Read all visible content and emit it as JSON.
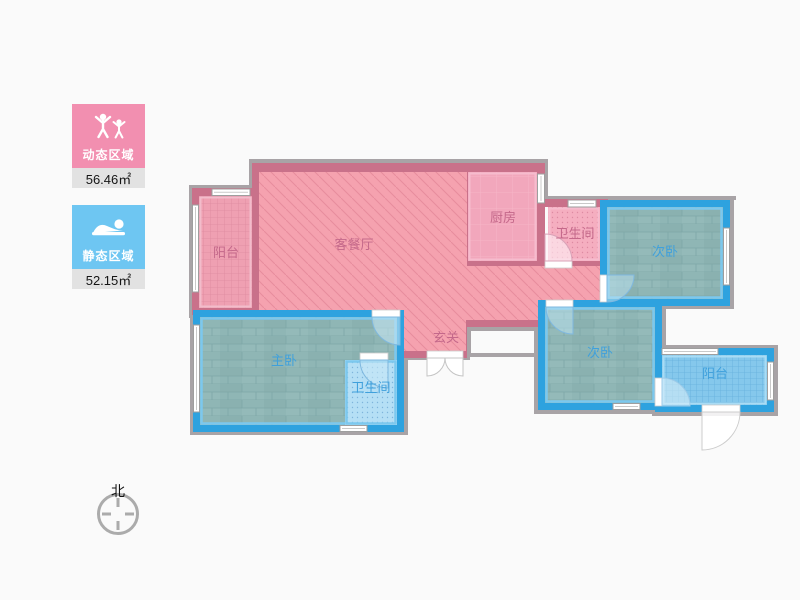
{
  "page": {
    "background": "#fafafa"
  },
  "legend": {
    "dynamic": {
      "label": "动态区域",
      "area": "56.46㎡",
      "color": "#f28fb0",
      "icon": "people-arms-up-icon"
    },
    "static": {
      "label": "静态区域",
      "area": "52.15㎡",
      "color": "#6ec6f2",
      "icon": "sleeping-person-icon"
    }
  },
  "compass": {
    "north_label": "北"
  },
  "floorplan": {
    "rooms": [
      {
        "id": "balcony-left",
        "label": "阳台",
        "zone": "dynamic",
        "floor": "pink-tile"
      },
      {
        "id": "living-dining",
        "label": "客餐厅",
        "zone": "dynamic",
        "floor": "pink-hatch"
      },
      {
        "id": "kitchen",
        "label": "厨房",
        "zone": "dynamic",
        "floor": "pink-plain"
      },
      {
        "id": "bath-top",
        "label": "卫生间",
        "zone": "dynamic",
        "floor": "pink-dots"
      },
      {
        "id": "entry",
        "label": "玄关",
        "zone": "dynamic",
        "floor": "pink-hatch"
      },
      {
        "id": "bedroom-top",
        "label": "次卧",
        "zone": "static",
        "floor": "wood"
      },
      {
        "id": "bedroom-master",
        "label": "主卧",
        "zone": "static",
        "floor": "wood"
      },
      {
        "id": "bath-bottom",
        "label": "卫生间",
        "zone": "static",
        "floor": "blue-dots"
      },
      {
        "id": "bedroom-bottom",
        "label": "次卧",
        "zone": "static",
        "floor": "wood"
      },
      {
        "id": "balcony-right",
        "label": "阳台",
        "zone": "static",
        "floor": "blue-tile"
      }
    ],
    "colors": {
      "wall_pink": "#c9718a",
      "wall_blue": "#2ea2df",
      "label_pink": "#c4688a",
      "label_blue": "#3fa0dc",
      "shadow_gray": "#a8a3a6"
    }
  }
}
